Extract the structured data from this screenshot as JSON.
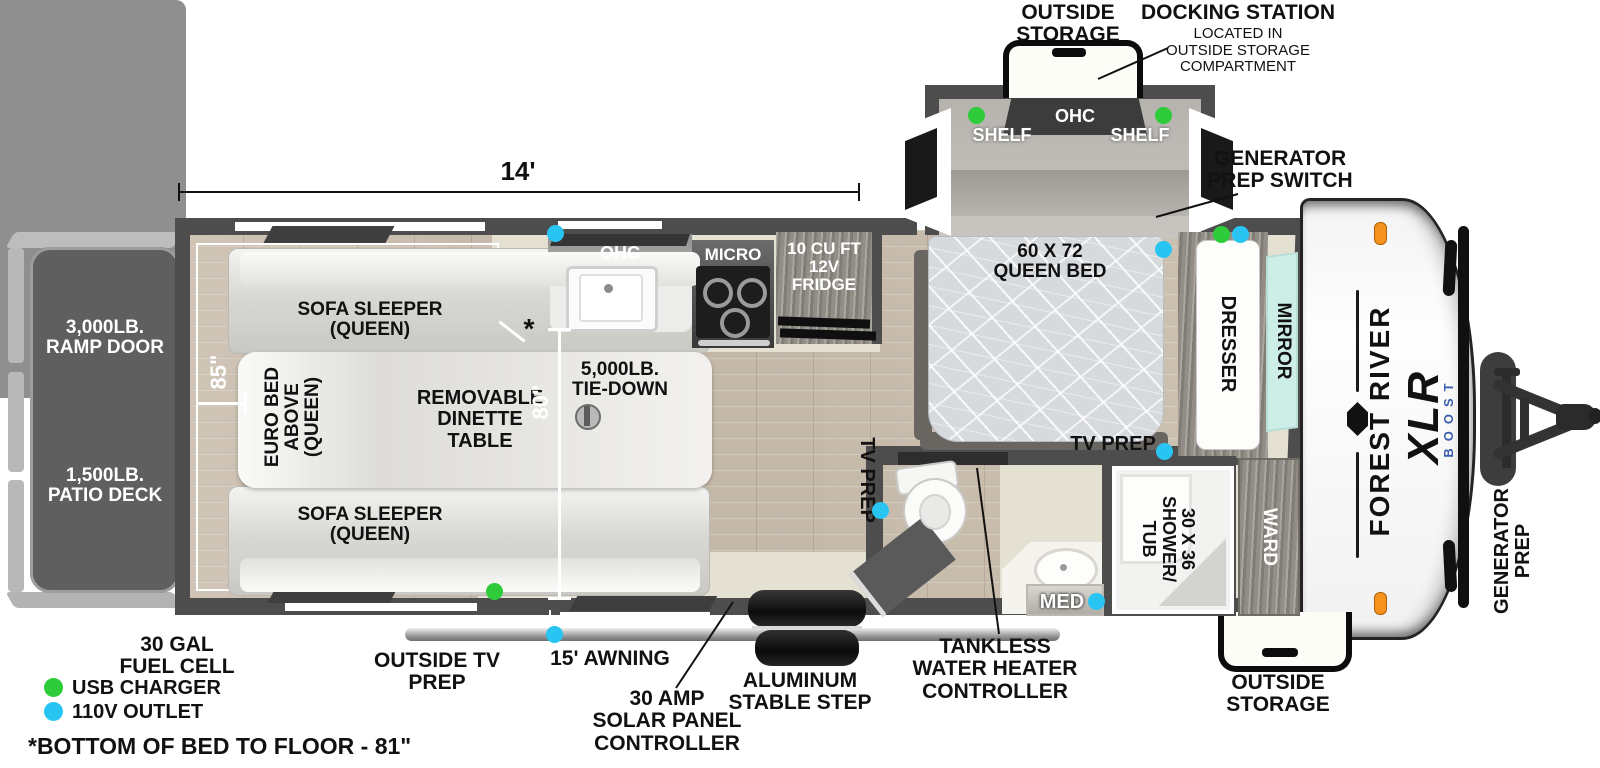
{
  "annotations": {
    "outside_storage": {
      "line1": "OUTSIDE",
      "line2": "STORAGE"
    },
    "docking_station": {
      "title": "DOCKING STATION",
      "sub1": "LOCATED IN",
      "sub2": "OUTSIDE STORAGE",
      "sub3": "COMPARTMENT"
    },
    "generator_prep_switch": {
      "line1": "GENERATOR",
      "line2": "PREP SWITCH"
    },
    "tankless": {
      "line1": "TANKLESS",
      "line2": "WATER HEATER",
      "line3": "CONTROLLER"
    },
    "solar": {
      "line1": "30 AMP",
      "line2": "SOLAR PANEL",
      "line3": "CONTROLLER"
    },
    "step": {
      "line1": "ALUMINUM",
      "line2": "STABLE STEP"
    },
    "awning": "15' AWNING",
    "outside_tv_prep": {
      "line1": "OUTSIDE TV",
      "line2": "PREP"
    },
    "fuel_cell": {
      "line1": "30 GAL",
      "line2": "FUEL CELL"
    },
    "generator_prep": {
      "line1": "GENERATOR",
      "line2": "PREP"
    },
    "bed_note": "*BOTTOM OF BED TO FLOOR - 81\""
  },
  "dimensions": {
    "length": "14'",
    "garage_length": "85\"",
    "garage_width": "80\"",
    "asterisk": "*"
  },
  "legend": {
    "usb": "USB CHARGER",
    "outlet": "110V OUTLET"
  },
  "rooms": {
    "ramp_door": {
      "line1": "3,000LB.",
      "line2": "RAMP DOOR"
    },
    "patio_deck": {
      "line1": "1,500LB.",
      "line2": "PATIO DECK"
    },
    "sofa": {
      "line1": "SOFA SLEEPER",
      "line2": "(QUEEN)"
    },
    "euro_bed": {
      "line1": "EURO BED",
      "line2": "ABOVE",
      "line3": "(QUEEN)"
    },
    "dinette": {
      "line1": "REMOVABLE",
      "line2": "DINETTE",
      "line3": "TABLE"
    },
    "tie_down": {
      "line1": "5,000LB.",
      "line2": "TIE-DOWN"
    },
    "ohc": "OHC",
    "micro": "MICRO",
    "fridge": {
      "line1": "10 CU FT",
      "line2": "12V",
      "line3": "FRIDGE"
    },
    "shelf": "SHELF",
    "queen_bed": {
      "line1": "60 X 72",
      "line2": "QUEEN BED"
    },
    "dresser": "DRESSER",
    "mirror": "MIRROR",
    "tv_prep": "TV PREP",
    "shower": {
      "line1": "30 X 36",
      "line2": "SHOWER/",
      "line3": "TUB"
    },
    "ward": "WARD",
    "med": "MED"
  },
  "brand": {
    "name": "FOREST RIVER",
    "model": "XLR",
    "trim": "BOOST"
  },
  "colors": {
    "usb_green": "#2ecc3a",
    "outlet_blue": "#29c5f2",
    "wall_gray": "#4d4d4d",
    "mirror_mint": "#cdeee7",
    "boost_blue": "#3a5dae",
    "marker_orange": "#f6921e"
  }
}
